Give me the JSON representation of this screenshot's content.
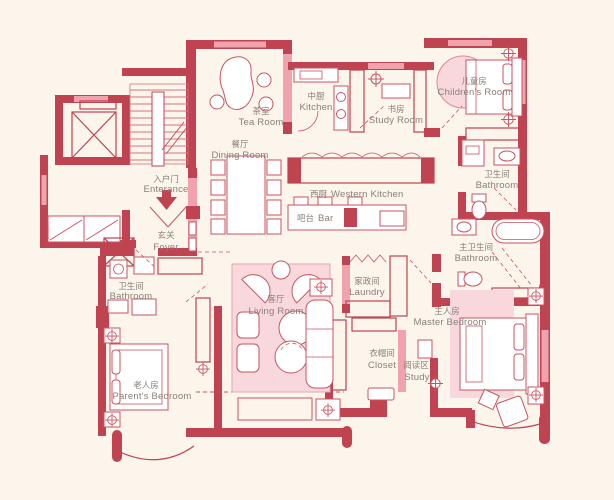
{
  "colors": {
    "wall": "#bf4350",
    "wall_light": "#f0a3ac",
    "room_fill_pink": "#f8d8dc",
    "furniture_line": "#c9545f",
    "background": "#fbf5ec",
    "label_text": "#8a7f76"
  },
  "rooms": {
    "tea_room": {
      "zh": "茶室",
      "en": "Tea Room"
    },
    "kitchen": {
      "zh": "中厨",
      "en": "Kitchen"
    },
    "study_room": {
      "zh": "书房",
      "en": "Study Room"
    },
    "childrens_room": {
      "zh": "儿童房",
      "en": "Children's Room"
    },
    "dining_room": {
      "zh": "餐厅",
      "en": "Dining Room"
    },
    "western_kitchen": {
      "zh": "西厨",
      "en": "Western Kitchen"
    },
    "bar": {
      "zh": "吧台",
      "en": "Bar"
    },
    "entrance": {
      "zh": "入户门",
      "en": "Enterance"
    },
    "foyer": {
      "zh": "玄关",
      "en": "Foyer"
    },
    "bathroom_top_right": {
      "zh": "卫生间",
      "en": "Bathroom"
    },
    "master_bathroom": {
      "zh": "主卫生间",
      "en": "Bathroom"
    },
    "bathroom_left": {
      "zh": "卫生间",
      "en": "Bathroom"
    },
    "living_room": {
      "zh": "客厅",
      "en": "Living Room"
    },
    "laundry": {
      "zh": "家政间",
      "en": "Laundry"
    },
    "master_bedroom": {
      "zh": "主人房",
      "en": "Master Bedroom"
    },
    "closet": {
      "zh": "衣帽间",
      "en": "Closet"
    },
    "reading_area": {
      "zh": "阅读区",
      "en": "Study"
    },
    "parents_bedroom": {
      "zh": "老人房",
      "en": "Parent's Bedroom"
    }
  }
}
